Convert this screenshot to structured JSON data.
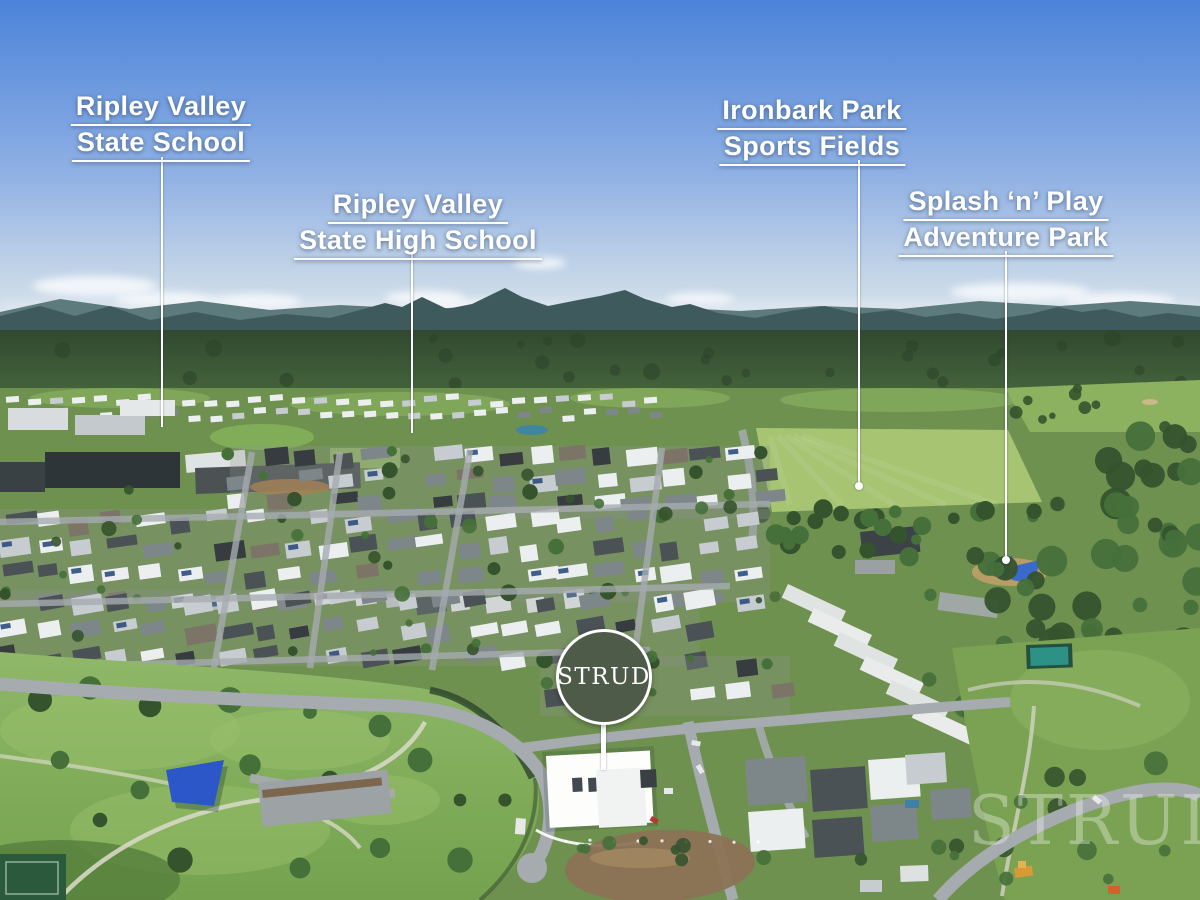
{
  "annotations": {
    "labels": [
      {
        "id": "ripley-valley-state-school",
        "line1": "Ripley Valley",
        "line2": "State School"
      },
      {
        "id": "ripley-valley-state-high-school",
        "line1": "Ripley Valley",
        "line2": "State High School"
      },
      {
        "id": "ironbark-park-sports-fields",
        "line1": "Ironbark Park",
        "line2": "Sports Fields"
      },
      {
        "id": "splash-n-play-adventure-park",
        "line1": "Splash ‘n’ Play",
        "line2": "Adventure Park"
      }
    ],
    "logo_badge": {
      "text": "STRUD"
    },
    "watermark": {
      "text": "STRUD"
    }
  },
  "scene": {
    "sky_top": "#4b83d9",
    "sky_mid": "#8fb0e4",
    "sky_low": "#c8d8e8",
    "sky_horizon": "#dfe8ee",
    "ridge_far": "#5d7a7c",
    "mountain": "#3f5a5c",
    "forest": "#44643c",
    "forest_dark": "#31492f",
    "meadow": "#6f9150",
    "field_light": "#a6c472",
    "golf_green": "#8cb25f",
    "park_green": "#74a24e",
    "park_light": "#8fb868",
    "tree": "#46703a",
    "tree_dark": "#35532d",
    "road": "#a5abaf",
    "suburb_ground": "#8e958f",
    "roof_white": "#eceff0",
    "roof_light": "#c6cccf",
    "roof_mid": "#7d8689",
    "roof_dark": "#4a5256",
    "roof_charcoal": "#363c40",
    "roof_brown": "#7c7467",
    "solar_blue": "#2e4e7e",
    "pond_blue": "#3f87a0",
    "dirt": "#8b7355",
    "mulch": "#7a5f45",
    "sail_blue": "#2b57c8",
    "court_teal": "#2d9185",
    "court_dark": "#2a5a3b",
    "machine_yellow": "#d89a35",
    "machine_orange": "#d2622a",
    "badge_green": "#4e5b49",
    "label_white": "#ffffff"
  }
}
